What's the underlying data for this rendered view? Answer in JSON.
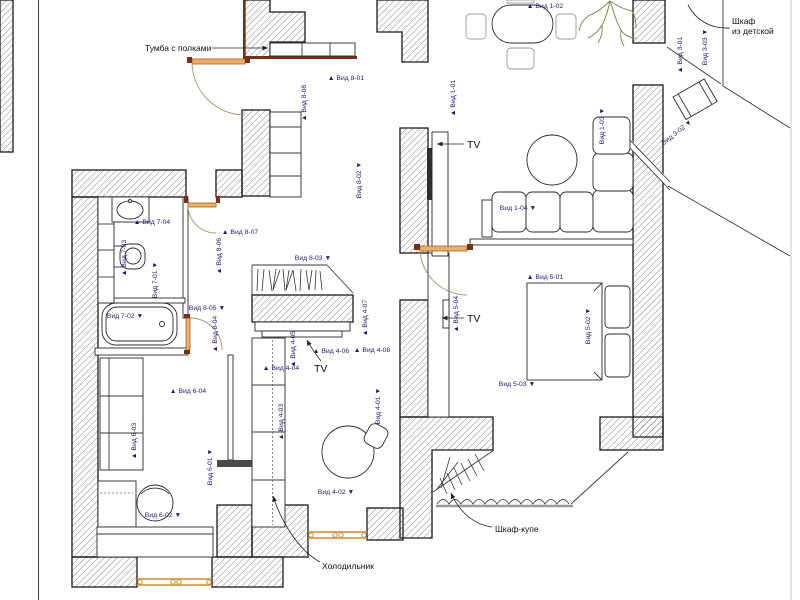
{
  "colors": {
    "wall_outline": "#1a1a1a",
    "hatch": "#6a6a6a",
    "view_label": "#1c1c7a",
    "door_orange": "#edb06a",
    "window_orange": "#d08a30",
    "jamb_brown": "#76301a",
    "tree_green": "#7c8c52",
    "callout_black": "#111111"
  },
  "callouts": {
    "tumba": "Тумба с полками",
    "wardrobe_line1": "Шкаф",
    "wardrobe_line2": "из детской",
    "tv": "TV",
    "fridge": "Холодильник",
    "slide_wardrobe": "Шкаф-купе"
  },
  "view_markers": [
    {
      "text": "Вид 1-01",
      "x": 455,
      "y": 98,
      "rot": -90,
      "tri": "before"
    },
    {
      "text": "Вид 1-02",
      "x": 545,
      "y": 8,
      "rot": 0,
      "tri": "before"
    },
    {
      "text": "Вид 1-03",
      "x": 604,
      "y": 126,
      "rot": -90,
      "tri": "after"
    },
    {
      "text": "Вид 1-04",
      "x": 518,
      "y": 210,
      "rot": 0,
      "tri": "after"
    },
    {
      "text": "Вид 3-01",
      "x": 682,
      "y": 55,
      "rot": -90,
      "tri": "before"
    },
    {
      "text": "Вид 3-02",
      "x": 678,
      "y": 134,
      "rot": -38,
      "tri": "after"
    },
    {
      "text": "Вид 3-03",
      "x": 707,
      "y": 47,
      "rot": -90,
      "tri": "after"
    },
    {
      "text": "Вид 4-01",
      "x": 380,
      "y": 406,
      "rot": -90,
      "tri": "after"
    },
    {
      "text": "Вид 4-02",
      "x": 336,
      "y": 494,
      "rot": 0,
      "tri": "after"
    },
    {
      "text": "Вид 4-03",
      "x": 283,
      "y": 422,
      "rot": -90,
      "tri": "before"
    },
    {
      "text": "Вид 4-04",
      "x": 281,
      "y": 370,
      "rot": 0,
      "tri": "before"
    },
    {
      "text": "Вид 4-05",
      "x": 295,
      "y": 349,
      "rot": -90,
      "tri": "before"
    },
    {
      "text": "Вид 4-06",
      "x": 331,
      "y": 353,
      "rot": 0,
      "tri": "before"
    },
    {
      "text": "Вид 4-07",
      "x": 367,
      "y": 318,
      "rot": -90,
      "tri": "before"
    },
    {
      "text": "Вид 4-08",
      "x": 372,
      "y": 352,
      "rot": 0,
      "tri": "before"
    },
    {
      "text": "Вид 5-01",
      "x": 545,
      "y": 279,
      "rot": 0,
      "tri": "before"
    },
    {
      "text": "Вид 5-02",
      "x": 590,
      "y": 326,
      "rot": -90,
      "tri": "after"
    },
    {
      "text": "Вид 5-03",
      "x": 517,
      "y": 386,
      "rot": 0,
      "tri": "after"
    },
    {
      "text": "Вид 5-04",
      "x": 458,
      "y": 314,
      "rot": -90,
      "tri": "before"
    },
    {
      "text": "Вид 6-01",
      "x": 212,
      "y": 467,
      "rot": -90,
      "tri": "after"
    },
    {
      "text": "Вид 6-02",
      "x": 163,
      "y": 517,
      "rot": 0,
      "tri": "after"
    },
    {
      "text": "Вид 6-03",
      "x": 136,
      "y": 441,
      "rot": -90,
      "tri": "before"
    },
    {
      "text": "Вид 6-04",
      "x": 188,
      "y": 393,
      "rot": 0,
      "tri": "before"
    },
    {
      "text": "Вид 7-01",
      "x": 157,
      "y": 280,
      "rot": -90,
      "tri": "after"
    },
    {
      "text": "Вид 7-02",
      "x": 125,
      "y": 318,
      "rot": 0,
      "tri": "after"
    },
    {
      "text": "Вид 7-03",
      "x": 126,
      "y": 258,
      "rot": -90,
      "tri": "before"
    },
    {
      "text": "Вид 7-04",
      "x": 152,
      "y": 224,
      "rot": 0,
      "tri": "before"
    },
    {
      "text": "Вид 8-01",
      "x": 346,
      "y": 80,
      "rot": 0,
      "tri": "before"
    },
    {
      "text": "Вид 8-02",
      "x": 361,
      "y": 180,
      "rot": -90,
      "tri": "after"
    },
    {
      "text": "Вид 8-03",
      "x": 313,
      "y": 260,
      "rot": 0,
      "tri": "after"
    },
    {
      "text": "Вид 8-04",
      "x": 217,
      "y": 334,
      "rot": -90,
      "tri": "before"
    },
    {
      "text": "Вид 8-05",
      "x": 207,
      "y": 310,
      "rot": 0,
      "tri": "after"
    },
    {
      "text": "Вид 8-06",
      "x": 221,
      "y": 256,
      "rot": -90,
      "tri": "before"
    },
    {
      "text": "Вид 8-07",
      "x": 240,
      "y": 234,
      "rot": 0,
      "tri": "before"
    },
    {
      "text": "Вид 8-08",
      "x": 306,
      "y": 103,
      "rot": -90,
      "tri": "before"
    }
  ]
}
